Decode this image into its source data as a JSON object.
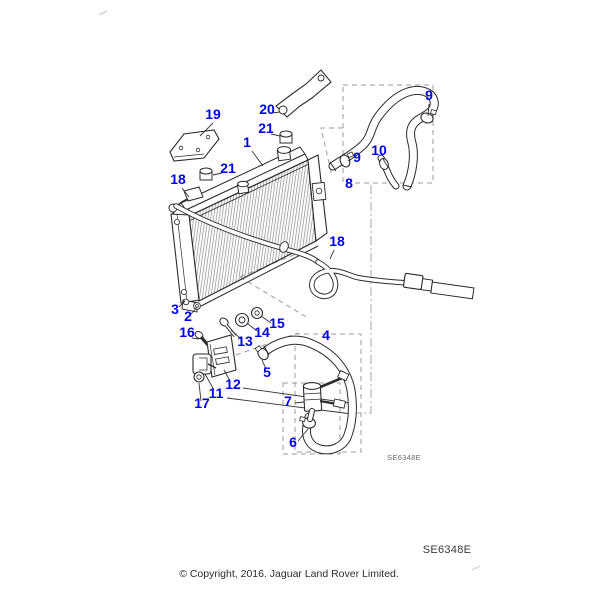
{
  "texts": {
    "diagram_code_small": "SE6348E",
    "diagram_code": "SE6348E",
    "copyright": "© Copyright, 2016. Jaguar Land Rover Limited."
  },
  "colors": {
    "label_blue": "#0000EE",
    "line": "#2b2b2b",
    "dashed_guide": "#9b9b9b",
    "background": "#ffffff"
  },
  "callouts": [
    {
      "id": "1",
      "label": "1",
      "x": 247,
      "y": 147,
      "leader": [
        252,
        151,
        263,
        166
      ]
    },
    {
      "id": "2",
      "label": "2",
      "x": 188,
      "y": 321,
      "leader": [
        191,
        314,
        197,
        307
      ]
    },
    {
      "id": "3",
      "label": "3",
      "x": 175,
      "y": 314,
      "leader": [
        179,
        307,
        185,
        301
      ]
    },
    {
      "id": "4",
      "label": "4",
      "x": 326,
      "y": 340,
      "leader": null
    },
    {
      "id": "5",
      "label": "5",
      "x": 267,
      "y": 377,
      "leader": [
        266,
        369,
        262,
        360
      ]
    },
    {
      "id": "6",
      "label": "6",
      "x": 293,
      "y": 447,
      "leader": [
        298,
        441,
        308,
        429
      ]
    },
    {
      "id": "7",
      "label": "7",
      "x": 288,
      "y": 406,
      "leader": [
        295,
        403,
        304,
        402
      ]
    },
    {
      "id": "8",
      "label": "8",
      "x": 349,
      "y": 188,
      "leader": null
    },
    {
      "id": "9a",
      "label": "9",
      "x": 357,
      "y": 162,
      "leader": [
        351,
        159,
        348,
        161
      ]
    },
    {
      "id": "9b",
      "label": "9",
      "x": 429,
      "y": 100,
      "leader": [
        429,
        104,
        428,
        116
      ]
    },
    {
      "id": "10",
      "label": "10",
      "x": 379,
      "y": 155,
      "leader": [
        383,
        159,
        388,
        167
      ]
    },
    {
      "id": "11",
      "label": "11",
      "x": 216,
      "y": 398,
      "leader": [
        214,
        390,
        205,
        374
      ]
    },
    {
      "id": "12",
      "label": "12",
      "x": 233,
      "y": 389,
      "leader": [
        230,
        381,
        224,
        370
      ]
    },
    {
      "id": "13",
      "label": "13",
      "x": 245,
      "y": 346,
      "leader": [
        241,
        339,
        231,
        330
      ]
    },
    {
      "id": "14",
      "label": "14",
      "x": 262,
      "y": 337,
      "leader": [
        257,
        331,
        247,
        323
      ]
    },
    {
      "id": "15",
      "label": "15",
      "x": 277,
      "y": 328,
      "leader": [
        271,
        323,
        261,
        316
      ]
    },
    {
      "id": "16",
      "label": "16",
      "x": 187,
      "y": 337,
      "leader": [
        192,
        338,
        199,
        339
      ]
    },
    {
      "id": "17",
      "label": "17",
      "x": 202,
      "y": 408,
      "leader": [
        201,
        401,
        199,
        383
      ]
    },
    {
      "id": "18a",
      "label": "18",
      "x": 178,
      "y": 184,
      "leader": [
        182,
        188,
        189,
        197
      ]
    },
    {
      "id": "18b",
      "label": "18",
      "x": 337,
      "y": 246,
      "leader": [
        334,
        250,
        330,
        259
      ]
    },
    {
      "id": "19",
      "label": "19",
      "x": 213,
      "y": 119,
      "leader": [
        213,
        123,
        200,
        136
      ]
    },
    {
      "id": "20",
      "label": "20",
      "x": 267,
      "y": 114,
      "leader": [
        272,
        113,
        280,
        112
      ]
    },
    {
      "id": "21a",
      "label": "21",
      "x": 228,
      "y": 173,
      "leader": [
        222,
        173,
        213,
        175
      ]
    },
    {
      "id": "21b",
      "label": "21",
      "x": 266,
      "y": 133,
      "leader": [
        271,
        134,
        280,
        136
      ]
    }
  ]
}
